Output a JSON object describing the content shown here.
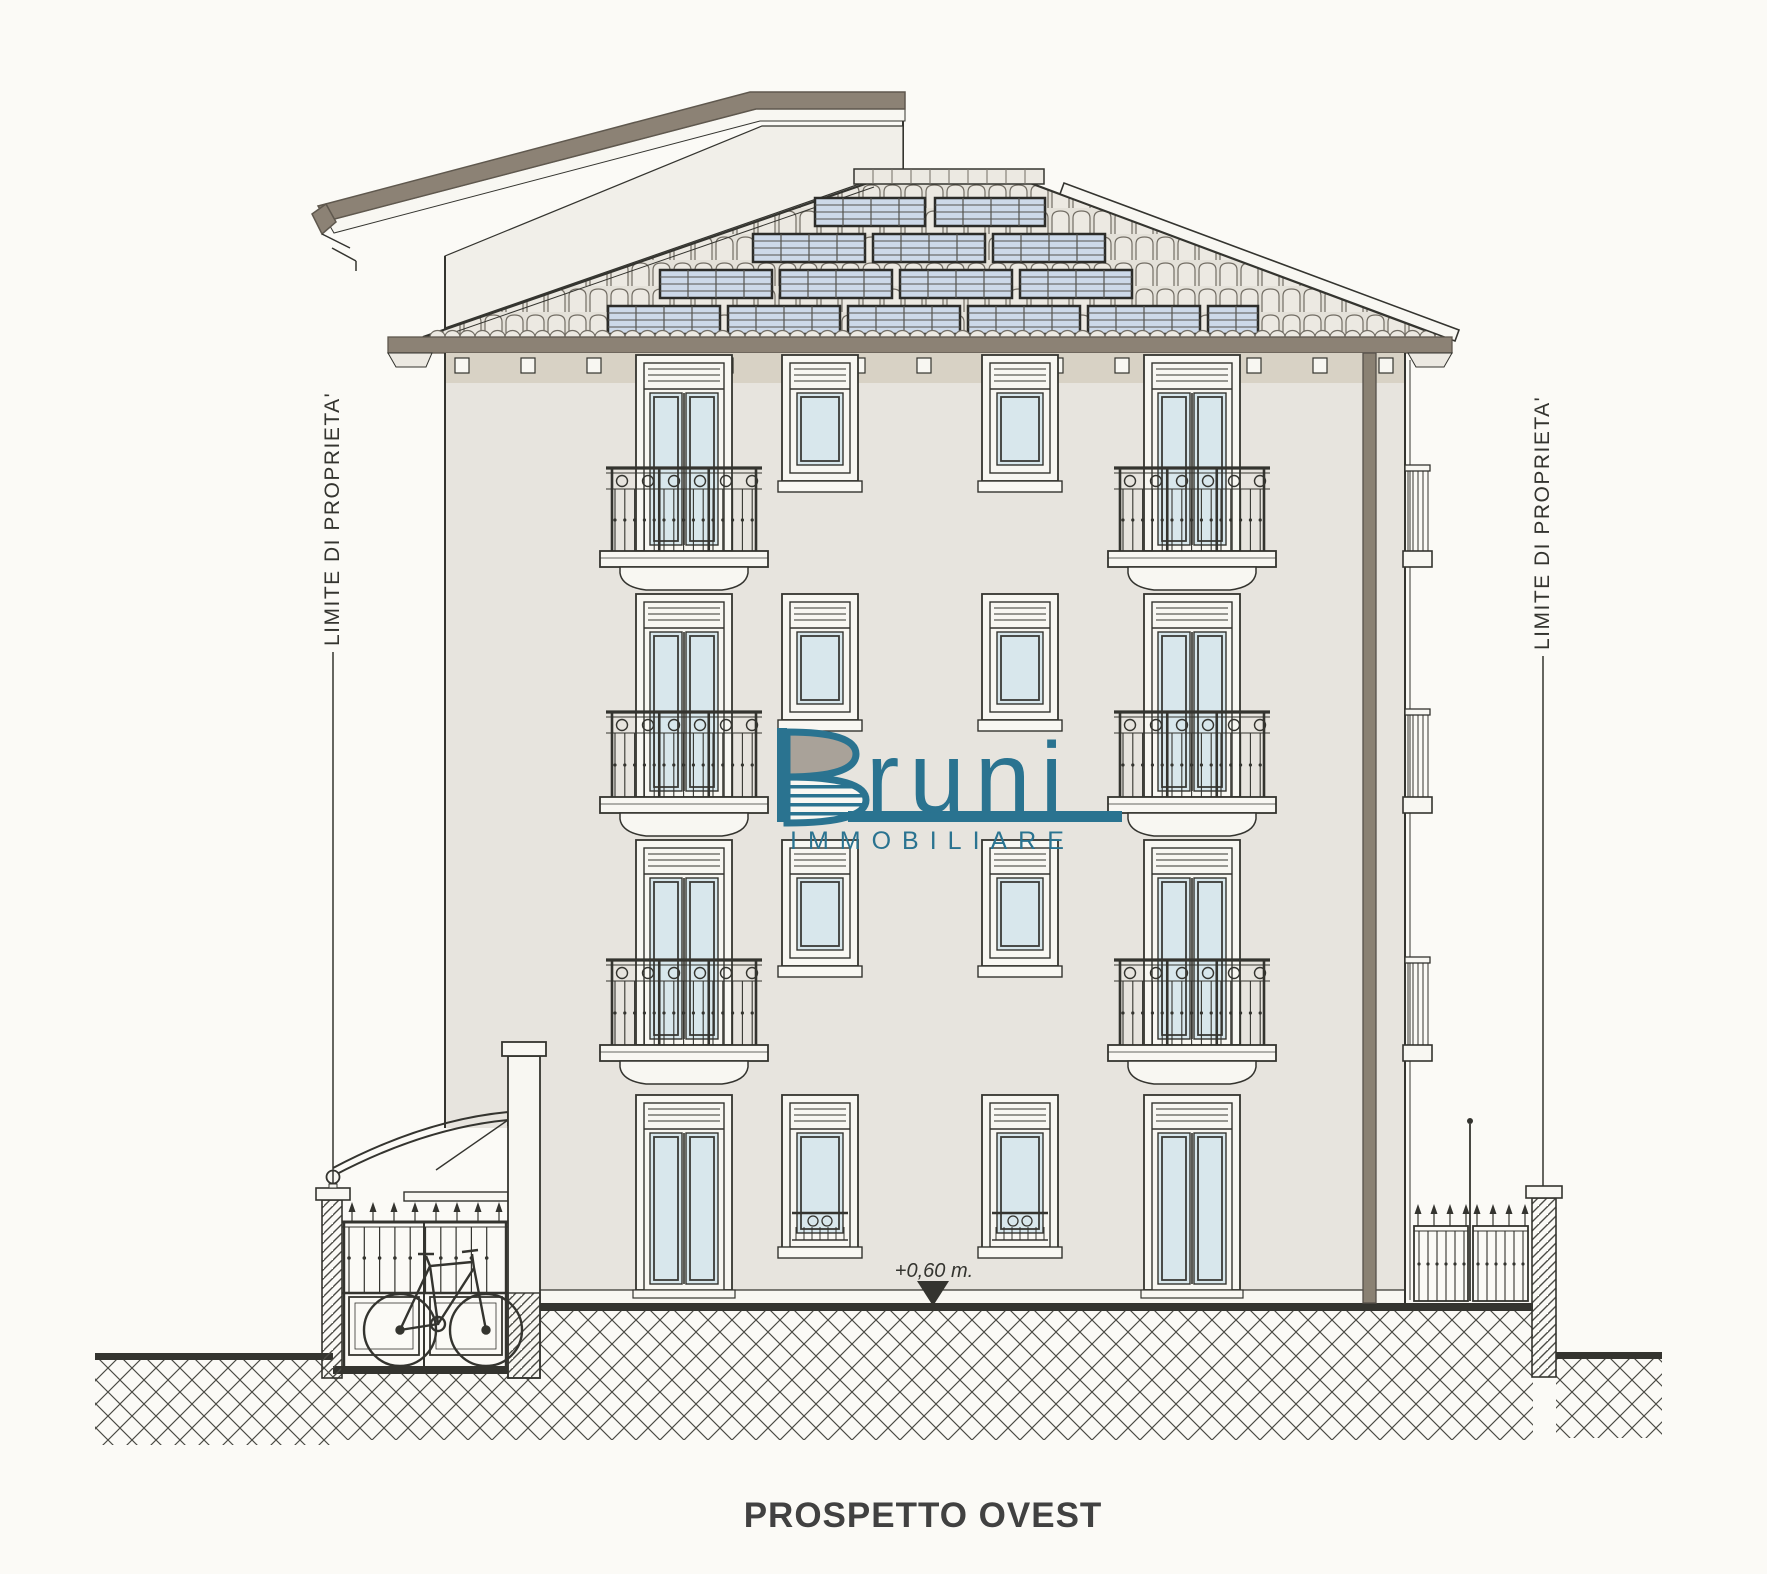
{
  "title": "PROSPETTO OVEST",
  "labels": {
    "property_limit_left": "LIMITE DI PROPRIETA'",
    "property_limit_right": "LIMITE DI PROPRIETA'",
    "level_marker": "+0,60 m."
  },
  "watermark": {
    "brand": "Bruni",
    "brand_display_tail": "runi",
    "subtitle": "IMMOBILIARE"
  },
  "drawing": {
    "subject": "west elevation of a four-storey residential building",
    "features": [
      "hipped tile roof with solar panels",
      "french doors with wrought-iron balconies",
      "bicycle shelter with curved canopy",
      "wrought-iron fences with masonry pillars",
      "ground hatching",
      "property limit lines"
    ]
  },
  "colors": {
    "paper": "#fbfaf6",
    "line": "#34342f",
    "facade": "#e7e4de",
    "facade_shadow": "#d8d2c5",
    "trim_white": "#f8f7f2",
    "roof_taupe": "#8c8275",
    "taupe_dark": "#5f584e",
    "downpipe": "#8a8173",
    "glass": "#d8e7ec",
    "solar_panel": "#cdd9e9",
    "solar_line": "#55534e",
    "roof_base": "#e4e1d9",
    "tile_fill": "#ece9e2",
    "tile_line": "#726d64",
    "hatch_line": "#4a4a44",
    "watermark_teal": "#2a7390",
    "watermark_gray": "#a9a299",
    "title_text": "#414141"
  }
}
